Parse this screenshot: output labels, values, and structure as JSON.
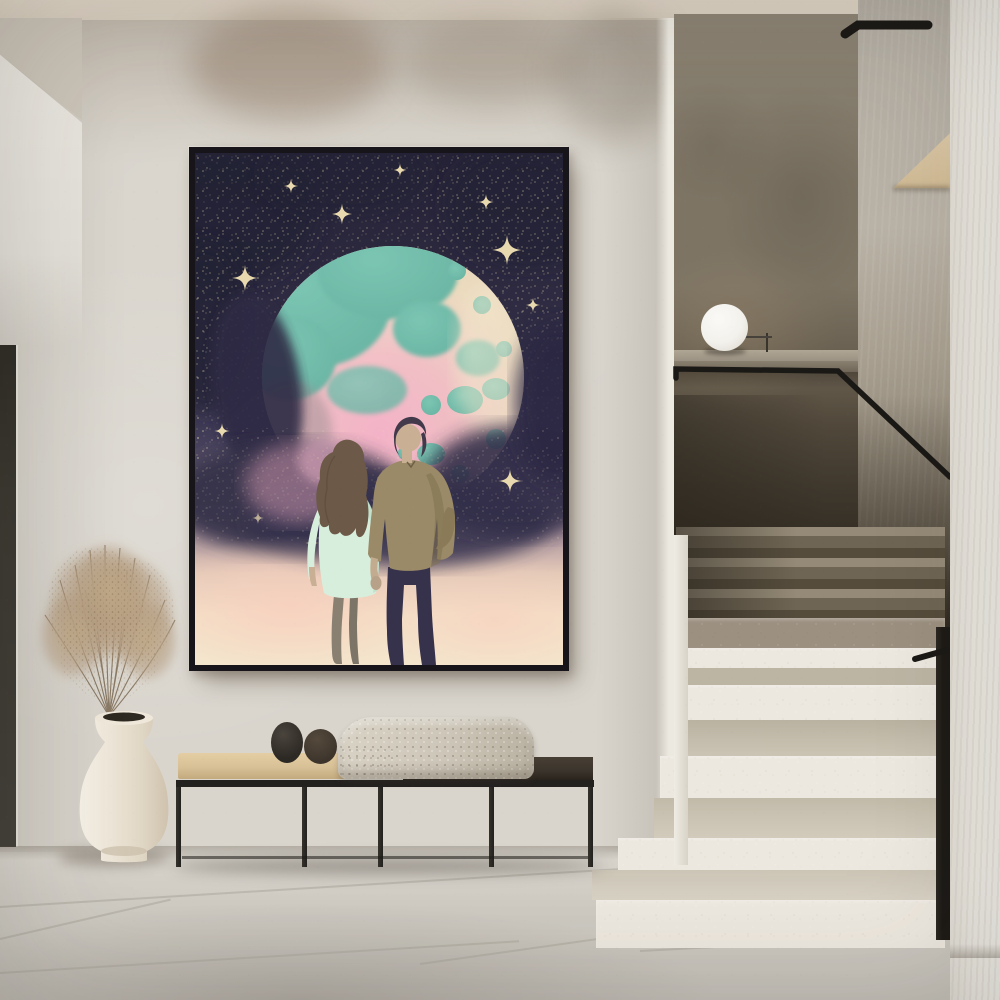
{
  "scene": {
    "title": "Minimal hallway interior with framed celestial poster, bench, vase of dried pampas and terrazzo staircase",
    "objects": [
      "framed moon-couple poster",
      "plaster wall",
      "ceiling soffit",
      "dark doorway edge",
      "black metal bench",
      "beige bench cushion",
      "dark wood bench top",
      "knit throw blanket",
      "two decor stones",
      "cream ceramic vase",
      "dried pampas grass",
      "terrazzo staircase",
      "black handrail",
      "white sphere lamp",
      "concrete parapet ledge",
      "wood under-stair wedge",
      "white side wall",
      "large tiled stone floor"
    ]
  },
  "artwork": {
    "subject": "couple holding hands before a giant pastel moon in a starry night sky",
    "style": "vintage risograph poster"
  },
  "colors": {
    "ceiling": "#d9cfc0",
    "wall": "#d9d5cd",
    "soffit_grey": "#cbc4b8",
    "door_dark": "#3b3931",
    "floor": "#cfcbc3",
    "seam": "#a7a399",
    "stair_wall": "#7c7363",
    "ledge": "#9b9183",
    "grey_strip": "#b0aa9f",
    "white_wall": "#ebe8e1",
    "wood_wedge": "#dac7a6",
    "lamp": "#f3f1ec",
    "rail": "#1b1916",
    "step_face": "#ece8df",
    "step_tread": "#c8c1b2",
    "bench_frame": "#23211e",
    "cushion": "#d8c096",
    "bench_top_dark": "#3a332b",
    "blanket": "#cdc6b8",
    "pebble1": "#2c2823",
    "pebble2": "#3d352c",
    "vase": "#ede5d7",
    "pampas": "#b49c80",
    "frame": "#17151a",
    "sky": "#302d45",
    "sky_deep": "#262337",
    "star": "#e9d9ae",
    "moon_cream": "#ead8bc",
    "moon_teal": "#68b3a2",
    "moon_pink": "#f2b3c6",
    "dust": "#343049",
    "poster_cream": "#f4e6cd",
    "hair_brown": "#6d5947",
    "shirt_mint": "#d8eedd",
    "jacket_tan": "#9a8a68",
    "silhouette": "#37324c",
    "skin": "#c9b095"
  }
}
